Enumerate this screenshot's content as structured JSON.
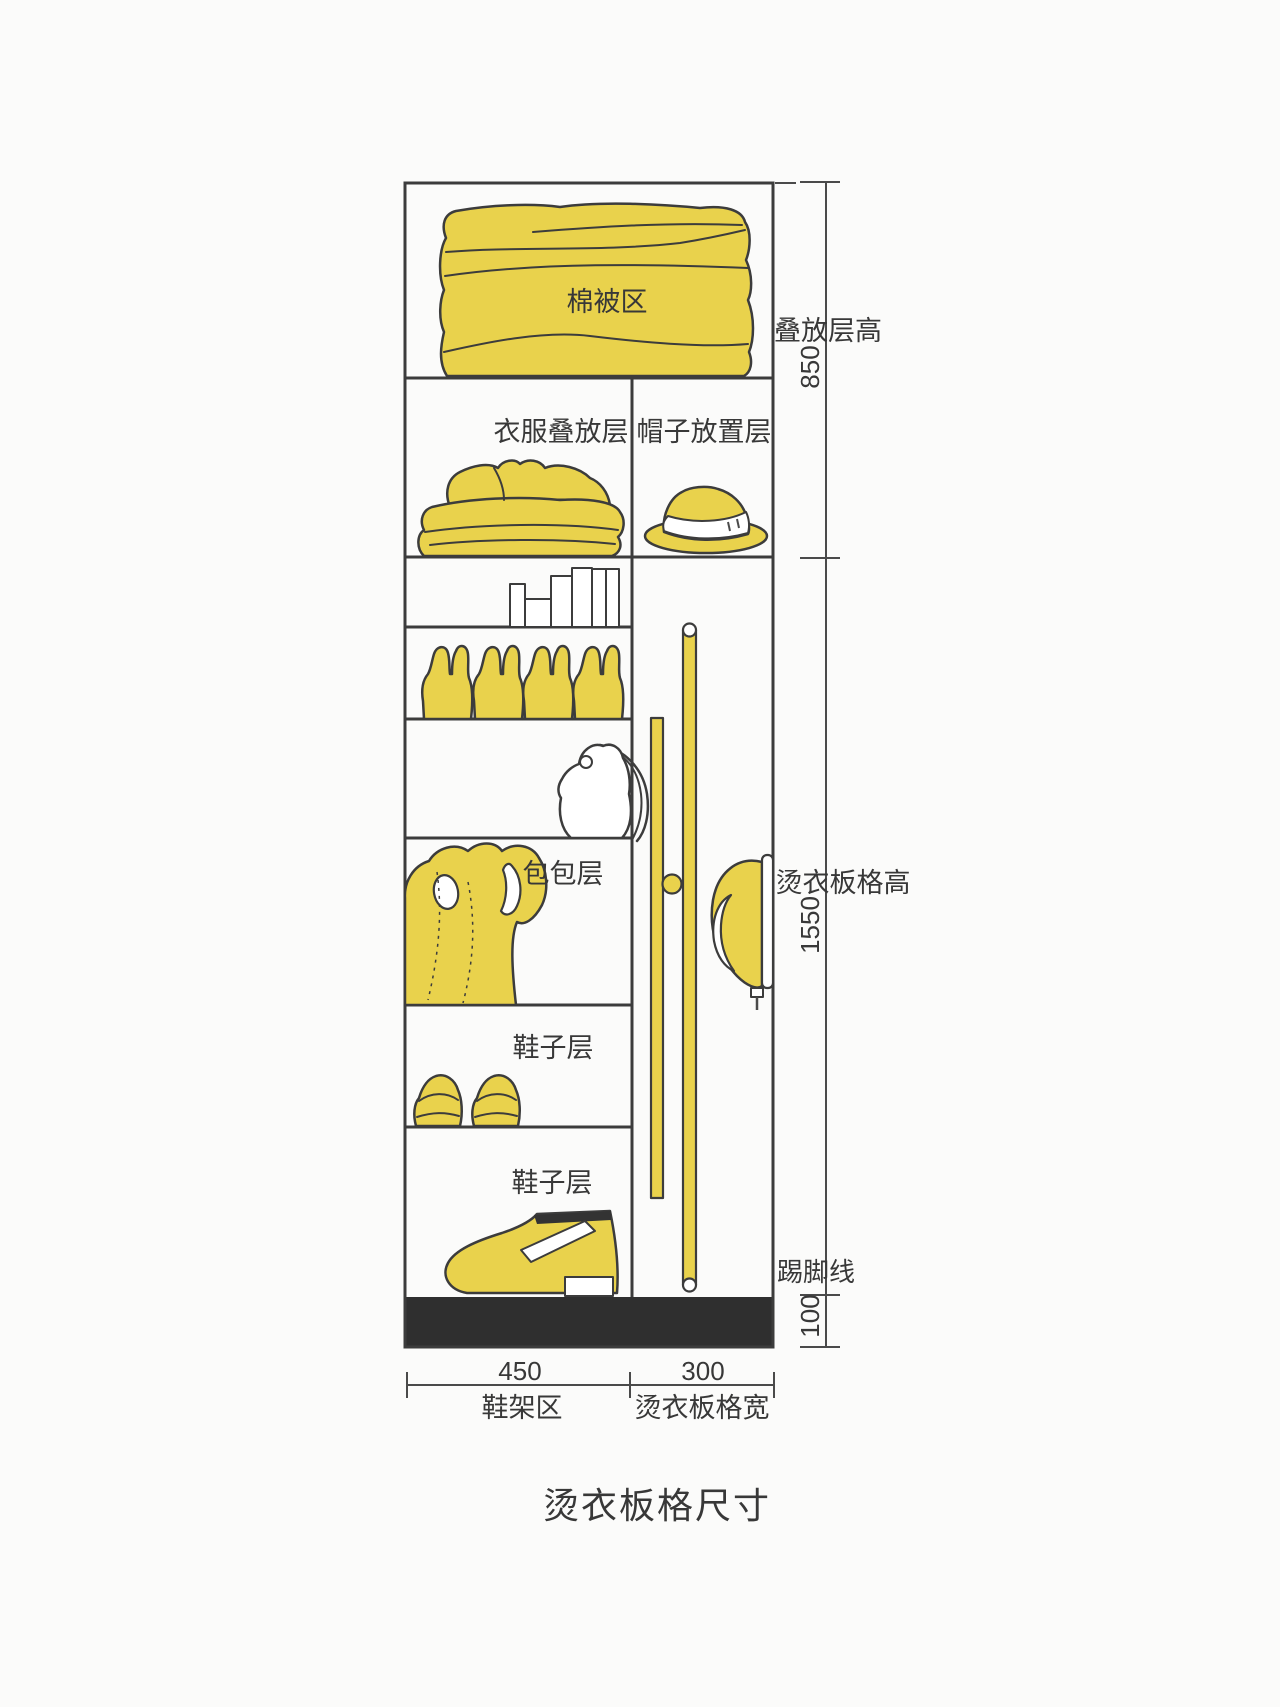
{
  "page_title": "烫衣板格尺寸",
  "colors": {
    "accent_yellow": "#e9d24c",
    "outline": "#3c3c3c",
    "plinth": "#2f2f2f",
    "dimension_line": "#4a4a4a",
    "text": "#383838",
    "background": "#fbfbfa"
  },
  "cabinet": {
    "sections": {
      "quilt_area": "棉被区",
      "clothes_stack": "衣服叠放层",
      "hat_shelf": "帽子放置层",
      "bag_shelf": "包包层",
      "shoe_shelf_upper": "鞋子层",
      "shoe_shelf_lower": "鞋子层"
    },
    "illustrations": [
      "quilt-icon",
      "folded-clothes-icon",
      "hat-icon",
      "storage-boxes-icon",
      "gloves-icon",
      "handbag-icon",
      "tote-bag-icon",
      "sneakers-icon",
      "leather-shoe-icon",
      "ironing-board-icon",
      "iron-icon"
    ]
  },
  "dimensions": {
    "right": [
      {
        "label": "叠放层高",
        "value": "850"
      },
      {
        "label": "烫衣板格高",
        "value": "1550"
      },
      {
        "label": "踢脚线",
        "value": "100"
      }
    ],
    "bottom": [
      {
        "label": "鞋架区",
        "value": "450"
      },
      {
        "label": "烫衣板格宽",
        "value": "300"
      }
    ]
  }
}
